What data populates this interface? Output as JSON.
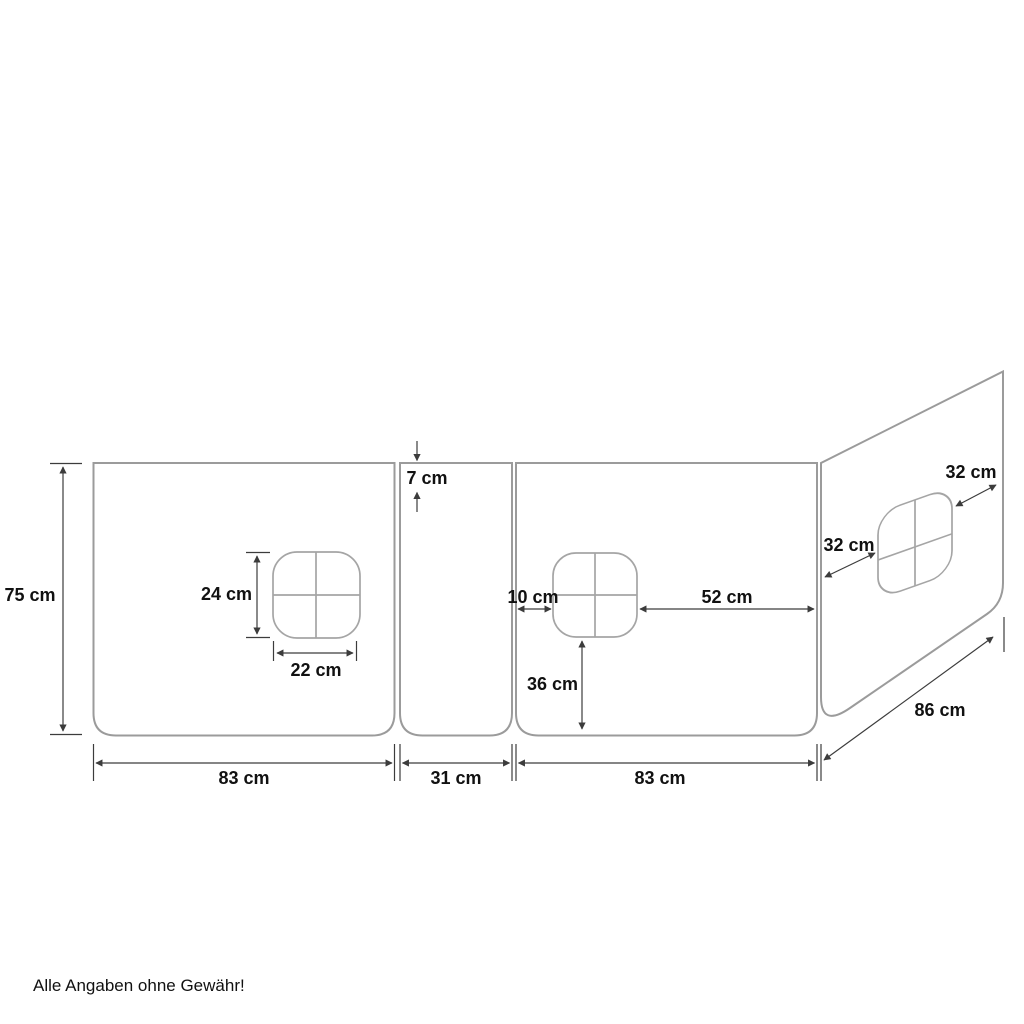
{
  "colors": {
    "background": "#ffffff",
    "stripe_fill": "#d7d7d7",
    "panel_outline": "#9b9b9b",
    "window_outline": "#a5a5a5",
    "dimension_lines": "#3c3c3c",
    "label_text": "#111111"
  },
  "dims": {
    "panel_height": "75 cm",
    "stripe_height": "7 cm",
    "left_window_height": "24 cm",
    "left_window_width": "22 cm",
    "left_panel_width": "83 cm",
    "middle_panel_width": "31 cm",
    "right_panel_width": "83 cm",
    "right_window_left_gap": "10 cm",
    "right_window_right_gap": "52 cm",
    "right_window_bottom_gap": "36 cm",
    "side_window_width": "32 cm",
    "side_window_height": "32 cm",
    "side_panel_depth": "86 cm"
  },
  "footer": {
    "disclaimer": "Alle Angaben ohne Gewähr!"
  }
}
